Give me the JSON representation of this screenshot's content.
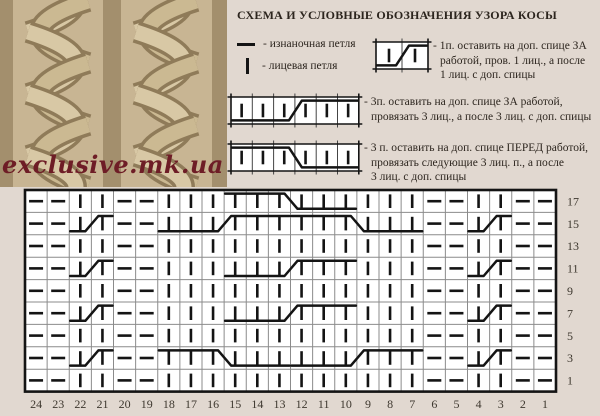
{
  "title": "СХЕМА И УСЛОВНЫЕ ОБОЗНАЧЕНИЯ УЗОРА КОСЫ",
  "watermark": "exclusive.mk.ua",
  "colors": {
    "background": "#e1d8d0",
    "cell_background": "#ffffff",
    "symbol": "#141414",
    "grid_inner_line": "#8b8b8b",
    "label_text": "#3e382f",
    "watermark_red": "#6e1d26",
    "knit_photo_beige": "#c8b593"
  },
  "legend": {
    "purl_label": "- изнаночная петля",
    "knit_label": "- лицевая петля",
    "cable1": {
      "symbol": {
        "cells": 2,
        "type": "back",
        "cell_w": 26,
        "cell_h": 27
      },
      "lines": [
        "- 1п. оставить на доп. спице ЗА",
        "работой, пров. 1 лиц., а после",
        "1 лиц. с доп. спицы"
      ]
    },
    "cable2": {
      "symbol": {
        "cells": 6,
        "type": "back",
        "cell_w": 21.3,
        "cell_h": 27
      },
      "lines": [
        "- 3п. оставить на доп. спице ЗА работой,",
        "провязать 3 лиц., а после 3 лиц. с доп. спицы"
      ]
    },
    "cable3": {
      "symbol": {
        "cells": 6,
        "type": "front",
        "cell_w": 21.3,
        "cell_h": 27
      },
      "lines": [
        "- 3 п. оставить на доп. спице ПЕРЕД работой,",
        "провязать следующие 3 лиц. п., а после",
        "3 лиц. с доп. спицы"
      ]
    }
  },
  "chart_data": {
    "type": "knitting-chart",
    "stitch_codes": {
      "p": "purl",
      "k": "knit"
    },
    "columns": [
      "24",
      "23",
      "22",
      "21",
      "20",
      "19",
      "18",
      "17",
      "16",
      "15",
      "14",
      "13",
      "12",
      "11",
      "10",
      "9",
      "8",
      "7",
      "6",
      "5",
      "4",
      "3",
      "2",
      "1"
    ],
    "rows": [
      {
        "label": "17",
        "stitches": "ppkkppkkkkkkkkkkkkppkkpp",
        "cables": [
          {
            "from": 15,
            "to": 10,
            "type": "front"
          }
        ]
      },
      {
        "label": "15",
        "stitches": "ppkkppkkkkkkkkkkkkppkkpp",
        "cables": [
          {
            "from": 22,
            "to": 21,
            "type": "back"
          },
          {
            "from": 18,
            "to": 13,
            "type": "back"
          },
          {
            "from": 12,
            "to": 7,
            "type": "front"
          },
          {
            "from": 4,
            "to": 3,
            "type": "back"
          }
        ]
      },
      {
        "label": "13",
        "stitches": "ppkkppkkkkkkkkkkkkppkkpp",
        "cables": []
      },
      {
        "label": "11",
        "stitches": "ppkkppkkkkkkkkkkkkppkkpp",
        "cables": [
          {
            "from": 22,
            "to": 21,
            "type": "back"
          },
          {
            "from": 15,
            "to": 10,
            "type": "back"
          },
          {
            "from": 4,
            "to": 3,
            "type": "back"
          }
        ]
      },
      {
        "label": "9",
        "stitches": "ppkkppkkkkkkkkkkkkppkkpp",
        "cables": []
      },
      {
        "label": "7",
        "stitches": "ppkkppkkkkkkkkkkkkppkkpp",
        "cables": [
          {
            "from": 22,
            "to": 21,
            "type": "back"
          },
          {
            "from": 15,
            "to": 10,
            "type": "back"
          },
          {
            "from": 4,
            "to": 3,
            "type": "back"
          }
        ]
      },
      {
        "label": "5",
        "stitches": "ppkkppkkkkkkkkkkkkppkkpp",
        "cables": []
      },
      {
        "label": "3",
        "stitches": "ppkkppkkkkkkkkkkkkppkkpp",
        "cables": [
          {
            "from": 22,
            "to": 21,
            "type": "back"
          },
          {
            "from": 18,
            "to": 13,
            "type": "front"
          },
          {
            "from": 12,
            "to": 7,
            "type": "back"
          },
          {
            "from": 4,
            "to": 3,
            "type": "back"
          }
        ]
      },
      {
        "label": "1",
        "stitches": "ppkkppkkkkkkkkkkkkppkkpp",
        "cables": []
      }
    ]
  }
}
